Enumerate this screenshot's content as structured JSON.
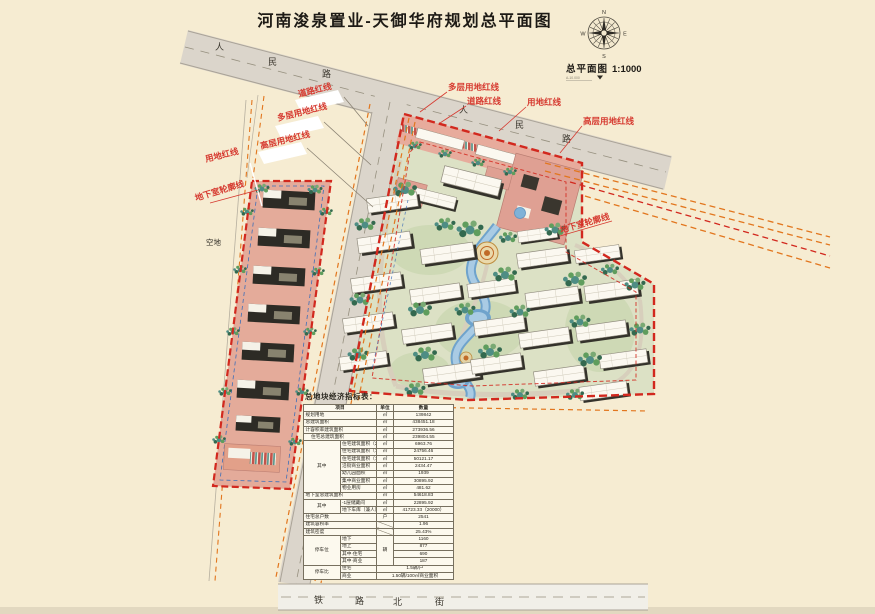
{
  "title": "河南浚泉置业-天御华府规划总平面图",
  "drawing_label": {
    "name": "总平面图",
    "scale": "1:1000",
    "note": "A-10.000"
  },
  "compass": {
    "n": "N",
    "e": "E",
    "s": "S",
    "w": "W"
  },
  "roads": {
    "renmin": [
      "人",
      "民",
      "路"
    ],
    "tielu": [
      "铁",
      "路",
      "北",
      "街"
    ]
  },
  "labels": {
    "daolu": "道路红线",
    "duoceng": "多层用地红线",
    "gaoceng": "高层用地红线",
    "yongdi": "用地红线",
    "dixiashi": "地下室轮廓线",
    "kongdi": "空地"
  },
  "table": {
    "title": "总地块经济指标表：",
    "headers": [
      "项目",
      "单位",
      "数量"
    ],
    "rows": [
      {
        "group": "",
        "item": "规划用地",
        "unit": "㎡",
        "qty": "139842"
      },
      {
        "group": "",
        "item": "总建筑面积",
        "unit": "㎡",
        "qty": "438451.18"
      },
      {
        "group": "",
        "item": "计容积率建筑面积",
        "unit": "㎡",
        "qty": "273936.56"
      },
      {
        "group": "",
        "item": "住宅总建筑面积",
        "unit": "㎡",
        "qty": "239804.55"
      },
      {
        "group": "其中",
        "item": "住宅建筑面积（26层）",
        "unit": "㎡",
        "qty": "6963.76"
      },
      {
        "group": "",
        "item": "住宅建筑面积（18层）",
        "unit": "㎡",
        "qty": "24756.46"
      },
      {
        "group": "",
        "item": "住宅建筑面积（11层）",
        "unit": "㎡",
        "qty": "50121.17"
      },
      {
        "group": "",
        "item": "沿街商业面积",
        "unit": "㎡",
        "qty": "2434.47"
      },
      {
        "group": "",
        "item": "幼儿园面积",
        "unit": "㎡",
        "qty": "1939"
      },
      {
        "group": "",
        "item": "集中商业面积",
        "unit": "㎡",
        "qty": "30895.92"
      },
      {
        "group": "",
        "item": "物业用房",
        "unit": "㎡",
        "qty": "481.62"
      },
      {
        "group": "",
        "item": "地下室总建筑面积",
        "unit": "㎡",
        "qty": "54618.83"
      },
      {
        "group": "其中",
        "item": "-1层储藏间",
        "unit": "㎡",
        "qty": "22895.92"
      },
      {
        "group": "",
        "item": "地下车库（兼人防）",
        "unit": "㎡",
        "qty": "41723.33（20000）"
      },
      {
        "group": "",
        "item": "住宅总户数",
        "unit": "户",
        "qty": "2541"
      },
      {
        "group": "",
        "item": "建筑容积率",
        "unit": "",
        "qty": "1.96"
      },
      {
        "group": "",
        "item": "建筑密度",
        "unit": "",
        "qty": "25.43%"
      },
      {
        "group": "停车位",
        "item": "地下",
        "unit": "辆",
        "qty": "1160"
      },
      {
        "group": "",
        "item": "地上",
        "unit": "",
        "qty": "877"
      },
      {
        "group": "",
        "item": "其中·住宅",
        "unit": "",
        "qty": "690"
      },
      {
        "group": "",
        "item": "其中·商业",
        "unit": "",
        "qty": "187"
      },
      {
        "group": "停车比",
        "item": "住宅",
        "unit": "",
        "qty": "1.5辆/户"
      },
      {
        "group": "",
        "item": "商业",
        "unit": "",
        "qty": "1.50辆/100㎡商业面积"
      }
    ]
  },
  "colors": {
    "paper": "#f6ecd2",
    "red_line": "#d2281e",
    "orange_line": "#e2761e",
    "label_red": "#d63a30",
    "road": "#dbd5cb",
    "water": "#6fa3cc",
    "tree": "#4e8d84",
    "parcel_pink": "#e4ab9a"
  }
}
